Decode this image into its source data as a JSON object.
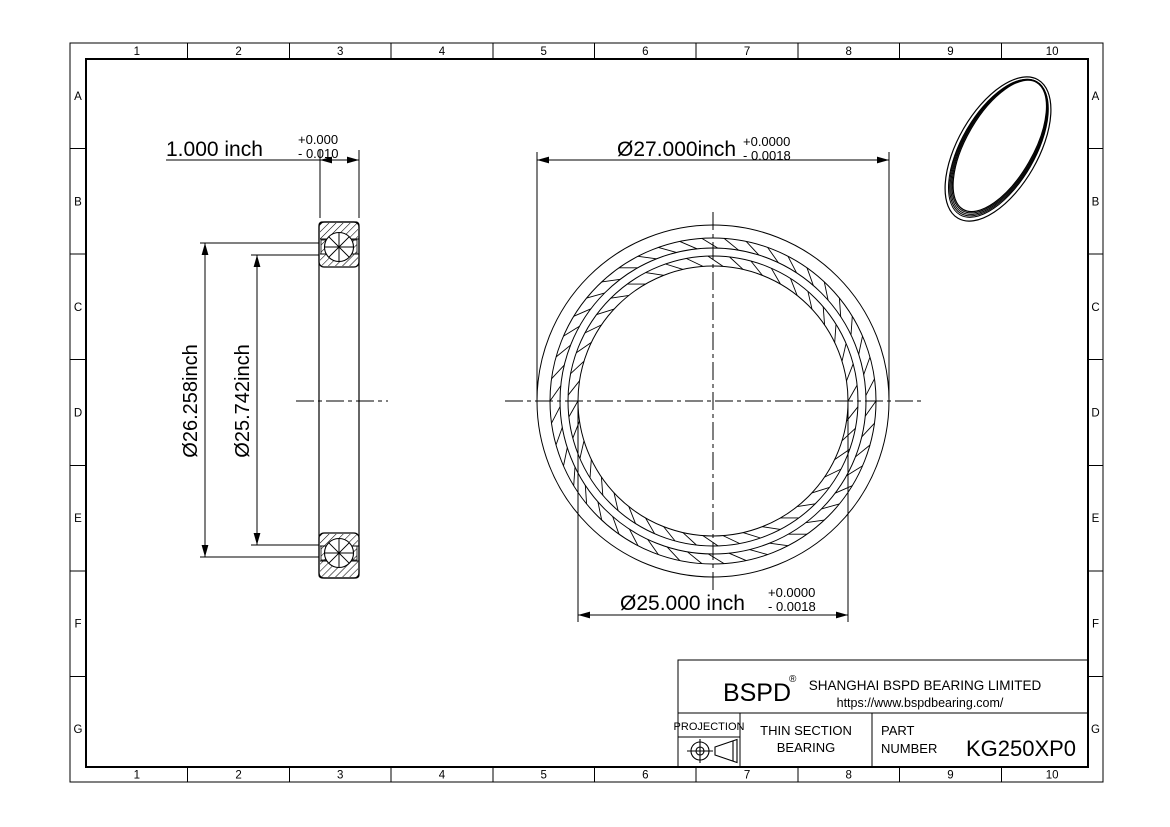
{
  "grid": {
    "columns": [
      "1",
      "2",
      "3",
      "4",
      "5",
      "6",
      "7",
      "8",
      "9",
      "10"
    ],
    "rows": [
      "A",
      "B",
      "C",
      "D",
      "E",
      "F",
      "G"
    ]
  },
  "dimensions": {
    "width": {
      "text": "1.000 inch",
      "tol_plus": "+0.000",
      "tol_minus": "- 0.010"
    },
    "od": {
      "text": "Ø27.000inch",
      "tol_plus": "+0.0000",
      "tol_minus": "- 0.0018"
    },
    "bore": {
      "text": "Ø25.000 inch",
      "tol_plus": "+0.0000",
      "tol_minus": "- 0.0018"
    },
    "outer_race": {
      "text": "Ø26.258inch"
    },
    "inner_race": {
      "text": "Ø25.742inch"
    }
  },
  "title_block": {
    "logo": "BSPD",
    "registered": "®",
    "company": "SHANGHAI BSPD BEARING LIMITED",
    "website": "https://www.bspdbearing.com/",
    "projection_label": "PROJECTION",
    "product_line1": "THIN SECTION",
    "product_line2": "BEARING",
    "part_label_line1": "PART",
    "part_label_line2": "NUMBER",
    "part_number": "KG250XP0"
  },
  "colors": {
    "ink": "#000000",
    "paper": "#ffffff"
  }
}
